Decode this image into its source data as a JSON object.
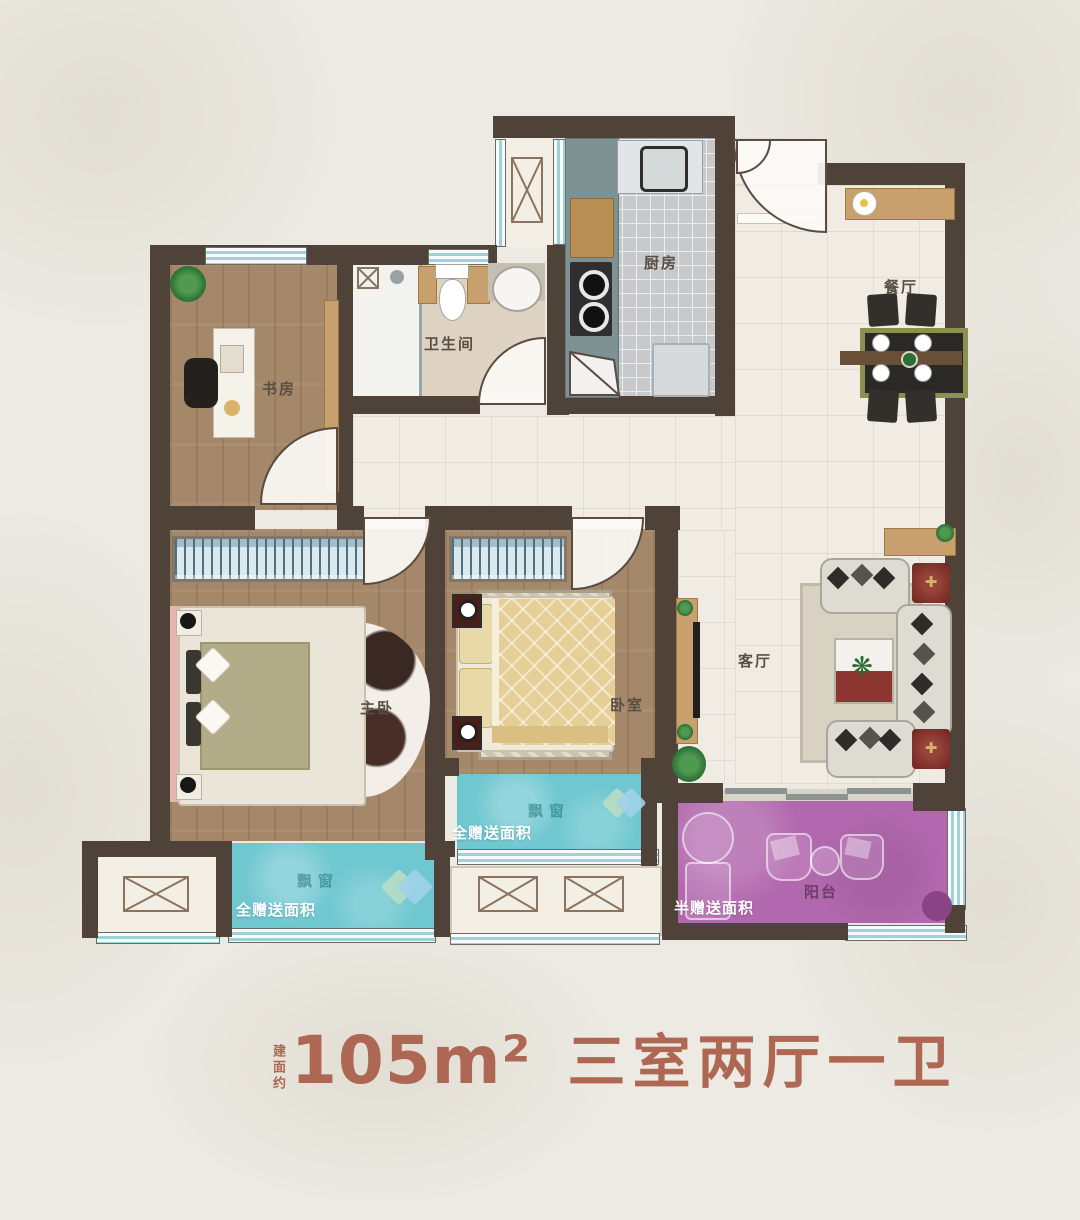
{
  "caption": {
    "prefix": "建面约",
    "area": "105m²",
    "layout": "三室两厅一卫"
  },
  "rooms": {
    "study": "书房",
    "bathroom": "卫生间",
    "kitchen": "厨房",
    "dining": "餐厅",
    "master_bedroom": "主卧",
    "bedroom": "卧室",
    "living_room": "客厅",
    "balcony": "阳台"
  },
  "annotations": {
    "bay_window_master": "飘窗",
    "bay_window_bedroom": "飘窗",
    "gift_full_master": "全赠送面积",
    "gift_full_bedroom": "全赠送面积",
    "gift_half_balcony": "半赠送面积"
  },
  "colors": {
    "wall": "#4f4239",
    "bay_window": "#6fc7d0",
    "balcony": "#b268ae",
    "wood_floor": "#a5886a",
    "tile_floor": "#f1ece3",
    "caption_text": "#ad6752"
  }
}
